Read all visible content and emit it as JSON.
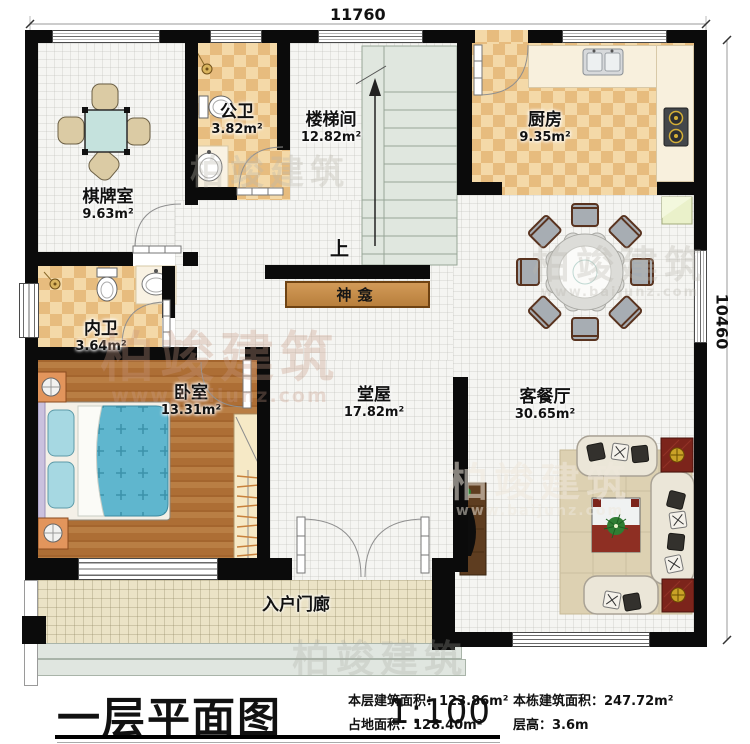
{
  "dimensions": {
    "top": "11760",
    "right": "10460"
  },
  "rooms": {
    "chess": {
      "name": "棋牌室",
      "area": "9.63m²"
    },
    "public_bath": {
      "name": "公卫",
      "area": "3.82m²"
    },
    "stairwell": {
      "name": "楼梯间",
      "area": "12.82m²"
    },
    "kitchen": {
      "name": "厨房",
      "area": "9.35m²"
    },
    "private_bath": {
      "name": "内卫",
      "area": "3.64m²"
    },
    "bedroom": {
      "name": "卧室",
      "area": "13.31m²"
    },
    "hall": {
      "name": "堂屋",
      "area": "17.82m²"
    },
    "living_dining": {
      "name": "客餐厅",
      "area": "30.65m²"
    },
    "shrine": {
      "name": "神龛"
    },
    "porch": {
      "name": "入户门廊"
    },
    "stairs_up_label": "上"
  },
  "title_block": {
    "title": "一层平面图",
    "scale": "1:100",
    "stats": [
      {
        "label": "本层建筑面积：",
        "value": "123.86m²"
      },
      {
        "label": "占地面积：",
        "value": "128.40m²"
      },
      {
        "label": "本栋建筑面积：",
        "value": "247.72m²"
      },
      {
        "label": "层高：",
        "value": "3.6m"
      }
    ]
  },
  "watermark": {
    "brand": "柏竣建筑",
    "url": "www.baijunz.com"
  },
  "colors": {
    "wall": "#0b0b0b",
    "checker_light": "#f4d9a8",
    "checker_dark": "#e7bc7e",
    "wood": "#b5773d",
    "tile": "#f5f5f2",
    "porch": "#ebe3c6",
    "shrine": "#c9934f",
    "bed": "#5fb6ce",
    "stairs": "#e0e7df",
    "counter": "#f8f0dd"
  }
}
